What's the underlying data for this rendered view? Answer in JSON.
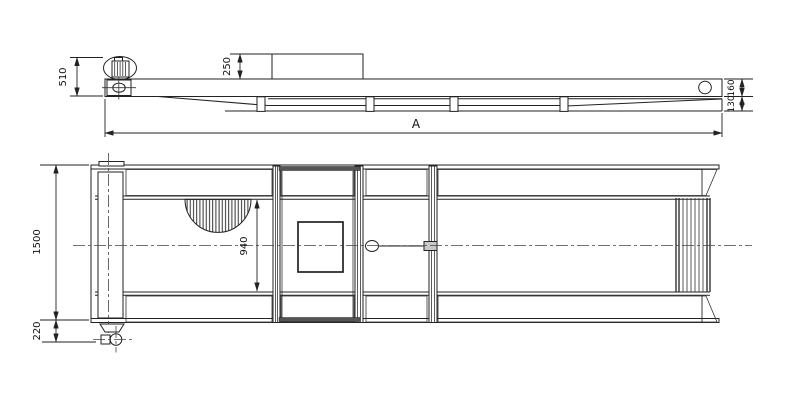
{
  "drawing": {
    "type": "technical-drawing-two-views",
    "background_color": "#ffffff",
    "line_color": "#222222",
    "side_view": {
      "dim_motor_height": "510",
      "dim_box_height": "250",
      "dim_overall_length": "A",
      "dim_beam_height": "160",
      "dim_rail_height": "130"
    },
    "plan_view": {
      "dim_overall_width": "1500",
      "dim_inner_width": "940",
      "dim_caster_offset": "220"
    }
  }
}
